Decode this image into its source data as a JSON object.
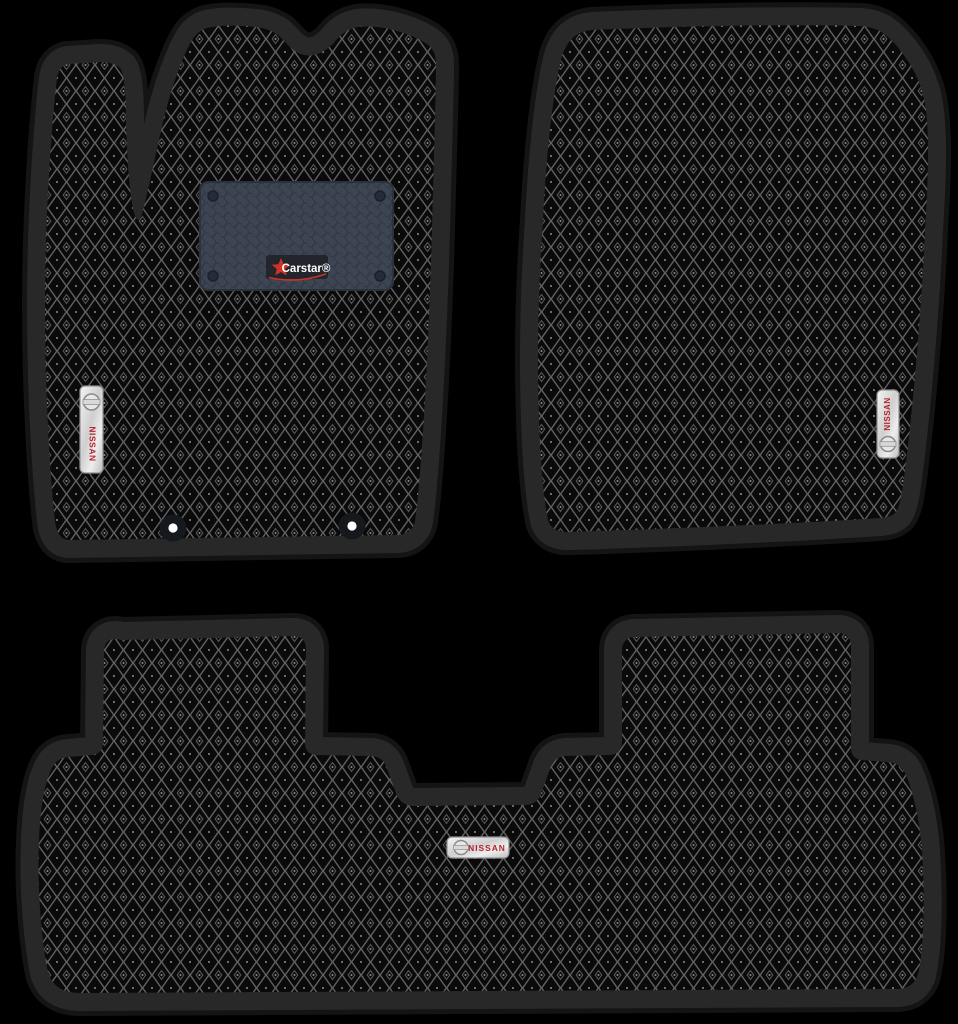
{
  "page": {
    "background_color": "#000000",
    "items_in_set": 3
  },
  "mats": {
    "driver": {
      "badge_label": "NISSAN",
      "brand_patch": {
        "label": "Carstar®"
      },
      "mounting_holes": 2
    },
    "passenger": {
      "badge_label": "NISSAN"
    },
    "rear": {
      "badge_label": "NISSAN"
    }
  },
  "colors": {
    "mat_cell": "#0a0a0a",
    "mat_grid": "#616161",
    "mat_border_band": "#282828",
    "mat_border_rim": "#141414",
    "heel_pad": "#3d4452",
    "heel_pad_lines": "#333a48",
    "badge_text": "#b5232b",
    "brand_star": "#cf3227",
    "brand_text": "#ffffff",
    "tag_metal": "#e9e9e9"
  }
}
